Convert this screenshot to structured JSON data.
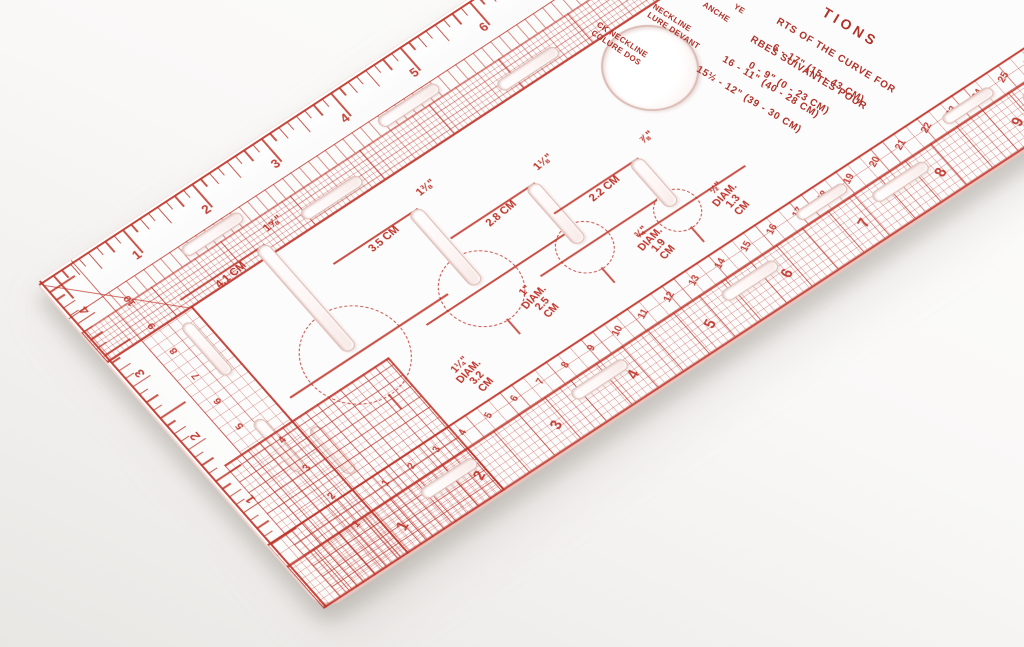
{
  "image_type": "photograph",
  "subject": "transparent-sewing-buttonhole-gauge-ruler",
  "colors": {
    "print_red": "#bf3227",
    "plastic_edge_pink": "#dfbcb5",
    "background": "#f5f4f2",
    "shadow": "rgba(148,139,131,0.38)"
  },
  "scales": {
    "top_inches": [
      "1",
      "2",
      "3",
      "4",
      "5",
      "6",
      "7",
      "8",
      "9",
      "10",
      "11",
      "12",
      "13",
      "14"
    ],
    "left_outer_inches": [
      "4",
      "3",
      "2",
      "1"
    ],
    "left_inner_cm": [
      "10",
      "9",
      "8",
      "7",
      "6",
      "5"
    ],
    "corner_cm": [
      "4",
      "3",
      "2",
      "1"
    ],
    "bottom_inner_cm": [
      "1",
      "2",
      "3",
      "4",
      "5",
      "6",
      "7",
      "8",
      "9",
      "10",
      "11",
      "12",
      "13",
      "14",
      "15",
      "16",
      "17",
      "18",
      "19",
      "20",
      "21",
      "22",
      "23",
      "24",
      "25",
      "26",
      "27",
      "28"
    ],
    "bottom_outer_inches": [
      "1",
      "2",
      "3",
      "4",
      "5",
      "6",
      "7",
      "8",
      "9",
      "10",
      "11"
    ]
  },
  "buttonholes": [
    {
      "length_label": "1⅝\"",
      "metric_label": "4.1 CM",
      "button_diameter_label": [
        "1¼\"",
        "DIAM.",
        "3.2",
        "CM"
      ]
    },
    {
      "length_label": "1⅜\"",
      "metric_label": "3.5 CM",
      "button_diameter_label": [
        "1\"",
        "DIAM.",
        "2.5",
        "CM"
      ]
    },
    {
      "length_label": "1⅛\"",
      "metric_label": "2.8 CM",
      "button_diameter_label": [
        "¾\"",
        "DIAM.",
        "1.9",
        "CM"
      ]
    },
    {
      "length_label": "⅞\"",
      "metric_label": "2.2 CM",
      "button_diameter_label": [
        "½\"",
        "DIAM.",
        "1.3",
        "CM"
      ]
    }
  ],
  "instructions": {
    "title_fragment": "TIONS",
    "lines": [
      "RTS OF THE CURVE FOR",
      "RBES SUIVANTES POUR",
      "6 - 17\" (15 - 43 CM)",
      "0 - 9\" (0 - 23 CM)",
      "16 - 11\" (40 - 28 CM)",
      "15½ - 12\" (39 - 30 CM)"
    ]
  },
  "garment_labels": [
    {
      "en": "CK NECKLINE",
      "fr": "COLURE DOS"
    },
    {
      "en": "NECKLINE",
      "fr": "LURE DEVANT"
    },
    {
      "en": "ANCHE",
      "fr": ""
    },
    {
      "en": "YE",
      "fr": ""
    }
  ]
}
